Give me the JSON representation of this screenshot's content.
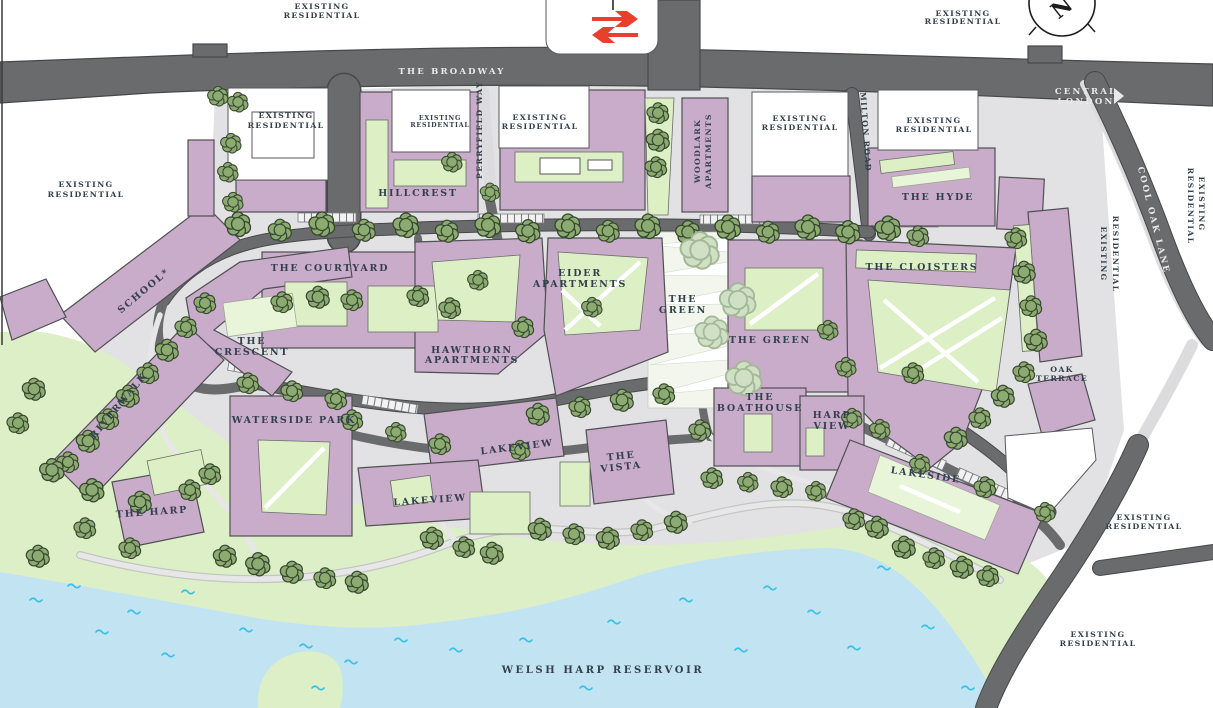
{
  "title": "Masterplan site map",
  "colors": {
    "building": "#c9abca",
    "outline": "#4f5052",
    "road": "#6a6b6d",
    "roadEdge": "#47484a",
    "pale": "#dcdcde",
    "paved": "#e2e2e4",
    "park": "#dcefc6",
    "courtyard": "#ddefc5",
    "courtPale": "#e9f5d9",
    "stripBase": "#f2f6ec",
    "water": "#c2e4f2",
    "wave": "#39c1e9",
    "tree": "#8cab70",
    "treeOutline": "#374631",
    "treeFaded": "#cfe0c5",
    "fadedOutline": "#a3b897",
    "label": "#33404d",
    "rail": "#e8402d"
  },
  "labels": {
    "existing": {
      "l1": "EXISTING",
      "l2": "RESIDENTIAL"
    },
    "broadway": "THE BROADWAY",
    "central_london": {
      "l1": "CENTRAL",
      "l2": "LONDON"
    },
    "perryfield": "PERRYFIELD WAY",
    "milton": "MILTON ROAD",
    "cool_oak": "COOL OAK LANE",
    "hillcrest": "HILLCREST",
    "woodlark": {
      "l1": "WOODLARK",
      "l2": "APARTMENTS"
    },
    "the_hyde": "THE HYDE",
    "school": "SCHOOL*",
    "courtyard": "THE COURTYARD",
    "eider": {
      "l1": "EIDER",
      "l2": "APARTMENTS"
    },
    "green_strip": {
      "l1": "THE",
      "l2": "GREEN"
    },
    "cloisters": "THE CLOISTERS",
    "crescent": {
      "l1": "THE",
      "l2": "CRESCENT"
    },
    "hawthorn": {
      "l1": "HAWTHORN",
      "l2": "APARTMENTS"
    },
    "green_building": "THE GREEN",
    "oak_terrace": {
      "l1": "OAK",
      "l2": "TERRACE"
    },
    "riverwalk": "RIVERWALK",
    "waterside": "WATERSIDE PARK",
    "boathouse": {
      "l1": "THE",
      "l2": "BOATHOUSE"
    },
    "harp_view": {
      "l1": "HARP",
      "l2": "VIEW"
    },
    "lakeview": "LAKEVIEW",
    "vista": {
      "l1": "THE",
      "l2": "VISTA"
    },
    "lakeside": "LAKESIDE",
    "the_harp": "THE HARP",
    "reservoir": "WELSH HARP RESERVOIR",
    "compass_north": "N"
  }
}
